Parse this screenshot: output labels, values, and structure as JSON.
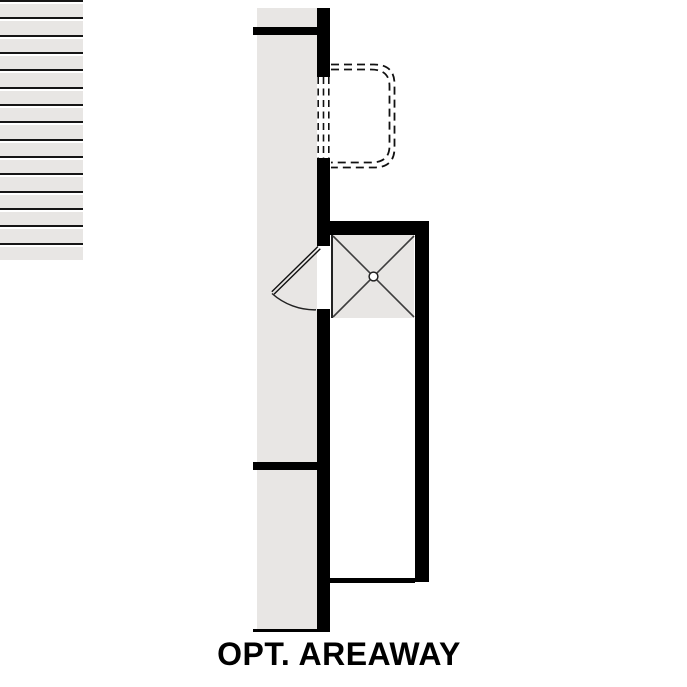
{
  "title": {
    "label": "OPT. AREAWAY"
  },
  "colors": {
    "wall": "#000000",
    "floor": "#e8e6e4",
    "line": "#222222",
    "background": "#ffffff"
  },
  "stair": {
    "tread_count": 15,
    "landing_marking": "X-cross",
    "has_center_drain_circle": true
  },
  "areaway": {
    "outline_style": "dashed-double-line",
    "window_dash_line_count": 3
  },
  "door": {
    "swing": "quarter-arc"
  }
}
